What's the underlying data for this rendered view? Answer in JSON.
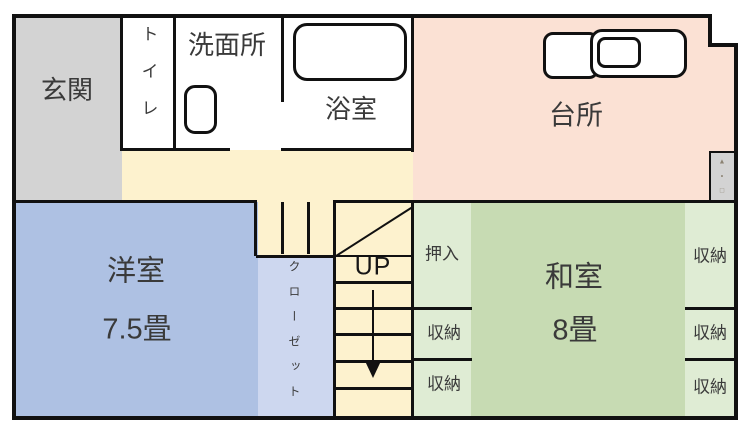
{
  "rooms": {
    "genkan": {
      "label": "玄関"
    },
    "toilet": {
      "label": "トイレ"
    },
    "washroom": {
      "label": "洗面所"
    },
    "bathroom": {
      "label": "浴室"
    },
    "kitchen": {
      "label": "台所"
    },
    "western_room": {
      "label": "洋室",
      "size": "7.5畳"
    },
    "closet": {
      "label": "クローゼット"
    },
    "stairs": {
      "direction_label": "UP"
    },
    "oshiire": {
      "label": "押入"
    },
    "storage_left": {
      "items": [
        "収納",
        "収納"
      ]
    },
    "japanese_room": {
      "label": "和室",
      "size": "8畳"
    },
    "storage_right": {
      "items": [
        "収納",
        "収納",
        "収納"
      ]
    }
  },
  "utility_panel": {
    "glyphs": [
      "▲",
      "•",
      "□"
    ]
  },
  "colors": {
    "wall": "#111111",
    "entrance_gray": "#d3d3d3",
    "hallway_cream": "#fdf2ce",
    "kitchen_pink": "#fbe1d4",
    "western_room_blue": "#aec1e3",
    "closet_blue": "#cdd7ef",
    "japanese_room_green": "#c7dbb3",
    "storage_green": "#dfecd4"
  }
}
